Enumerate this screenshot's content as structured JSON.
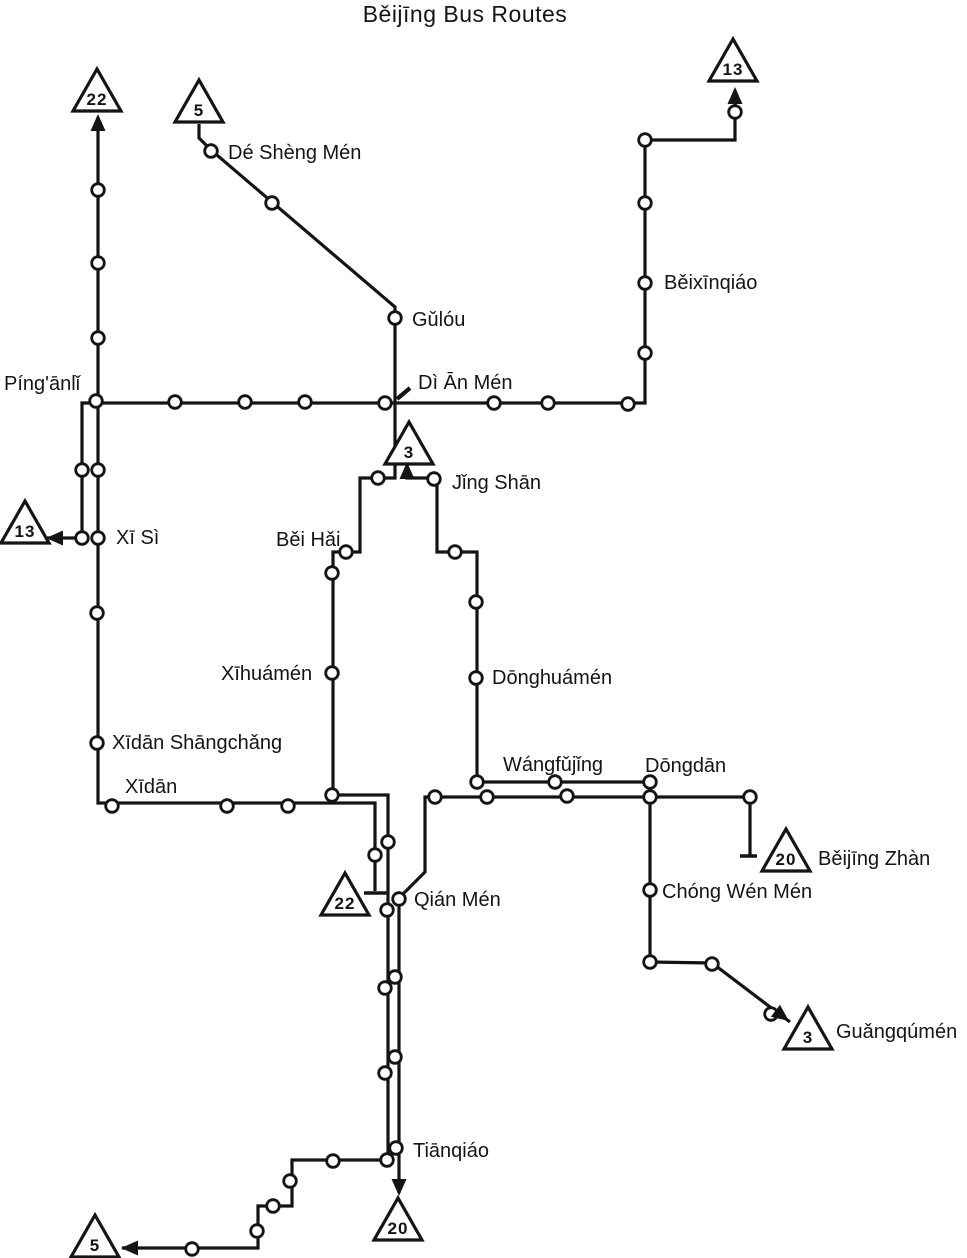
{
  "title": "Běijīng Bus Routes",
  "colors": {
    "ink": "#141414",
    "bg": "#ffffff"
  },
  "canvas": {
    "width": 967,
    "height": 1258
  },
  "map": {
    "routes": [
      {
        "name": "Route 22",
        "number": "22",
        "points": [
          [
            98,
            117
          ],
          [
            98,
            803
          ],
          [
            375,
            803
          ],
          [
            375,
            891
          ]
        ]
      },
      {
        "name": "Route 13",
        "number": "13",
        "points": [
          [
            47,
            538
          ],
          [
            82,
            538
          ],
          [
            82,
            403
          ],
          [
            645,
            403
          ],
          [
            645,
            140
          ],
          [
            735,
            140
          ],
          [
            735,
            90
          ]
        ]
      },
      {
        "name": "Route 5",
        "number": "5",
        "points": [
          [
            199,
            124
          ],
          [
            199,
            138
          ],
          [
            211,
            150
          ],
          [
            395,
            307
          ],
          [
            395,
            478
          ],
          [
            360,
            478
          ],
          [
            360,
            552
          ],
          [
            333,
            552
          ],
          [
            333,
            795
          ],
          [
            388,
            795
          ],
          [
            388,
            1160
          ],
          [
            292,
            1160
          ],
          [
            292,
            1206
          ],
          [
            258,
            1206
          ],
          [
            258,
            1248
          ],
          [
            122,
            1248
          ]
        ]
      },
      {
        "name": "Route 3",
        "number": "3",
        "points": [
          [
            407,
            461
          ],
          [
            407,
            478
          ],
          [
            437,
            478
          ],
          [
            437,
            552
          ],
          [
            477,
            552
          ],
          [
            477,
            782
          ],
          [
            650,
            782
          ],
          [
            650,
            962
          ],
          [
            712,
            963
          ],
          [
            790,
            1022
          ]
        ]
      },
      {
        "name": "Route 20",
        "number": "20",
        "points": [
          [
            750,
            855
          ],
          [
            750,
            797
          ],
          [
            425,
            797
          ],
          [
            425,
            872
          ],
          [
            399,
            898
          ],
          [
            399,
            1193
          ]
        ]
      }
    ],
    "terminus_bars": [
      [
        [
          364,
          893
        ],
        [
          387,
          893
        ]
      ],
      [
        [
          740,
          856
        ],
        [
          757,
          856
        ]
      ]
    ],
    "pointer_tick": [
      [
        397,
        399
      ],
      [
        410,
        388
      ]
    ],
    "arrows": [
      {
        "x": 98,
        "y": 114,
        "dir": "up"
      },
      {
        "x": 735,
        "y": 87,
        "dir": "up"
      },
      {
        "x": 46,
        "y": 538,
        "dir": "left"
      },
      {
        "x": 407,
        "y": 462,
        "dir": "up"
      },
      {
        "x": 789,
        "y": 1021,
        "dir": "down-right"
      },
      {
        "x": 399,
        "y": 1196,
        "dir": "down"
      },
      {
        "x": 121,
        "y": 1248,
        "dir": "left"
      }
    ],
    "terminals": [
      {
        "number": "22",
        "cx": 97,
        "cy": 92
      },
      {
        "number": "5",
        "cx": 199,
        "cy": 103
      },
      {
        "number": "13",
        "cx": 733,
        "cy": 62
      },
      {
        "number": "13",
        "cx": 25,
        "cy": 524
      },
      {
        "number": "3",
        "cx": 409,
        "cy": 445
      },
      {
        "number": "22",
        "cx": 345,
        "cy": 896
      },
      {
        "number": "20",
        "cx": 786,
        "cy": 852
      },
      {
        "number": "3",
        "cx": 808,
        "cy": 1030
      },
      {
        "number": "20",
        "cx": 398,
        "cy": 1221
      },
      {
        "number": "5",
        "cx": 95,
        "cy": 1238
      }
    ],
    "stops": [
      [
        98,
        190
      ],
      [
        98,
        263
      ],
      [
        98,
        338
      ],
      [
        96,
        401
      ],
      [
        98,
        470
      ],
      [
        98,
        538
      ],
      [
        97,
        613
      ],
      [
        97,
        743
      ],
      [
        112,
        806
      ],
      [
        227,
        806
      ],
      [
        288,
        806
      ],
      [
        375,
        855
      ],
      [
        82,
        470
      ],
      [
        82,
        538
      ],
      [
        175,
        402
      ],
      [
        245,
        402
      ],
      [
        305,
        402
      ],
      [
        385,
        403
      ],
      [
        494,
        403
      ],
      [
        548,
        403
      ],
      [
        628,
        404
      ],
      [
        645,
        353
      ],
      [
        645,
        283
      ],
      [
        645,
        203
      ],
      [
        645,
        140
      ],
      [
        735,
        112
      ],
      [
        211,
        151
      ],
      [
        272,
        203
      ],
      [
        395,
        318
      ],
      [
        378,
        478
      ],
      [
        346,
        552
      ],
      [
        332,
        573
      ],
      [
        332,
        673
      ],
      [
        332,
        795
      ],
      [
        388,
        842
      ],
      [
        387,
        910
      ],
      [
        385,
        988
      ],
      [
        385,
        1073
      ],
      [
        387,
        1160
      ],
      [
        333,
        1161
      ],
      [
        290,
        1181
      ],
      [
        273,
        1206
      ],
      [
        257,
        1231
      ],
      [
        192,
        1249
      ],
      [
        434,
        479
      ],
      [
        455,
        552
      ],
      [
        476,
        602
      ],
      [
        476,
        678
      ],
      [
        477,
        782
      ],
      [
        555,
        782
      ],
      [
        650,
        782
      ],
      [
        650,
        797
      ],
      [
        650,
        890
      ],
      [
        650,
        962
      ],
      [
        712,
        964
      ],
      [
        771,
        1014
      ],
      [
        750,
        797
      ],
      [
        567,
        796
      ],
      [
        487,
        797
      ],
      [
        435,
        797
      ],
      [
        399,
        899
      ],
      [
        395,
        977
      ],
      [
        395,
        1057
      ],
      [
        396,
        1148
      ]
    ],
    "stations": [
      {
        "name": "Dé Shèng Mén",
        "x": 228,
        "y": 152
      },
      {
        "name": "Gǔlóu",
        "x": 412,
        "y": 319
      },
      {
        "name": "Píng'ānlǐ",
        "x": 4,
        "y": 383
      },
      {
        "name": "Dì Ān Mén",
        "x": 418,
        "y": 382
      },
      {
        "name": "Běixīnqiáo",
        "x": 664,
        "y": 282
      },
      {
        "name": "Xī Sì",
        "x": 116,
        "y": 537
      },
      {
        "name": "Běi Hǎi",
        "x": 276,
        "y": 539
      },
      {
        "name": "Jǐng Shān",
        "x": 452,
        "y": 482
      },
      {
        "name": "Xīhuámén",
        "x": 221,
        "y": 673
      },
      {
        "name": "Dōnghuámén",
        "x": 492,
        "y": 677
      },
      {
        "name": "Xīdān Shāngchǎng",
        "x": 112,
        "y": 742
      },
      {
        "name": "Xīdān",
        "x": 125,
        "y": 786
      },
      {
        "name": "Wángfǔjǐng",
        "x": 503,
        "y": 764
      },
      {
        "name": "Dōngdān",
        "x": 645,
        "y": 765
      },
      {
        "name": "Běijīng Zhàn",
        "x": 818,
        "y": 858
      },
      {
        "name": "Chóng Wén Mén",
        "x": 662,
        "y": 891
      },
      {
        "name": "Guǎngqúmén",
        "x": 836,
        "y": 1031
      },
      {
        "name": "Qián Mén",
        "x": 414,
        "y": 899
      },
      {
        "name": "Tiānqiáo",
        "x": 413,
        "y": 1150
      }
    ]
  }
}
